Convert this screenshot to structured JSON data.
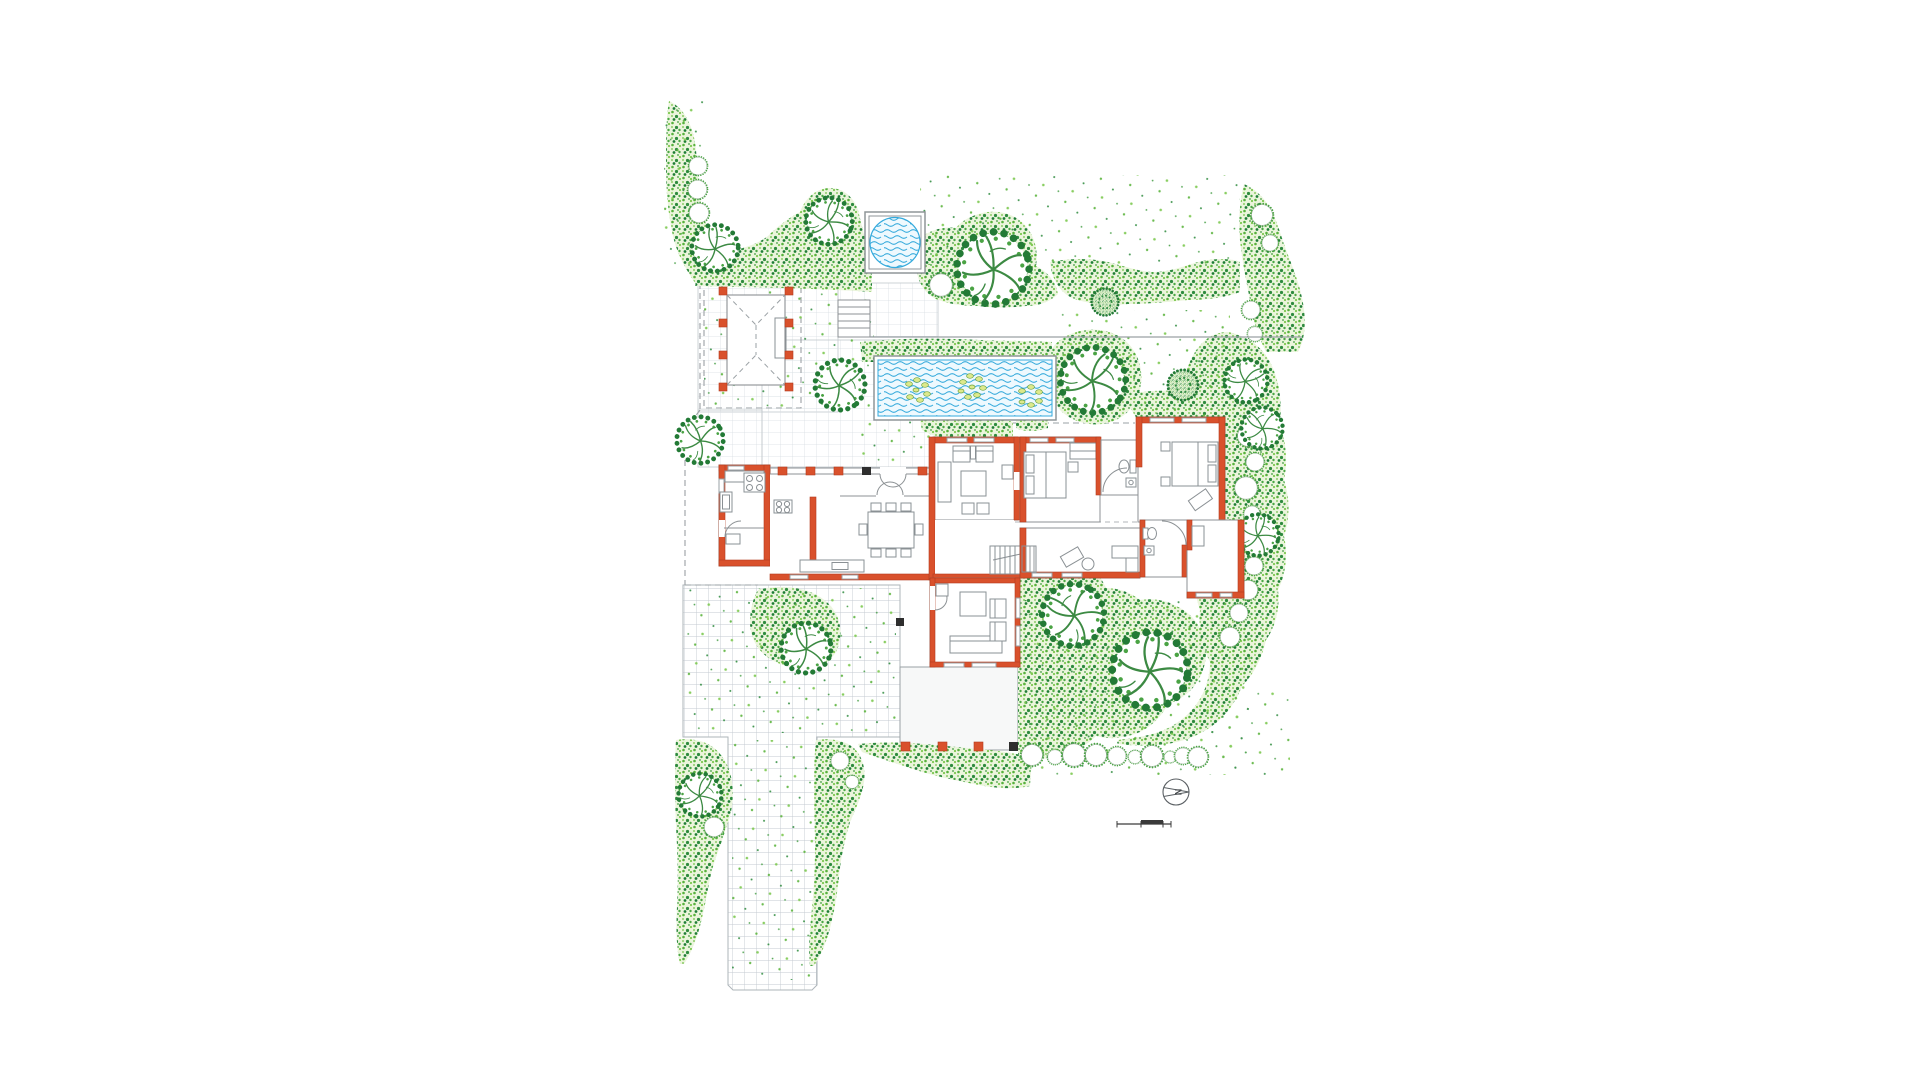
{
  "document": {
    "kind": "hand-rendered landscape site plan with ground-floor house plan",
    "visible_text": [
      "N"
    ]
  },
  "compass": {
    "label": "N"
  },
  "scale_bar": {
    "style": "stepped metric bar, unlabeled ticks"
  },
  "palette": {
    "background": "#ffffff",
    "foliage_wash": "#ebf5dc",
    "foliage_light": "#7cc84f",
    "foliage_mid": "#4aa844",
    "foliage_dark": "#1e7d36",
    "tree_outline": "#237a36",
    "branch_green": "#3c8a43",
    "water_line": "#35aadc",
    "water_fill": "#eef9fe",
    "lily_green": "#dde98c",
    "wall_red": "#d9512c",
    "line_grey": "#8c9194",
    "grid_grey": "#cdd4d8",
    "pier_black": "#2e2e2e",
    "frame_grey": "#8f9598"
  },
  "plan": {
    "elements": [
      "boundary-hedges",
      "specimen-trees",
      "shrub-balls",
      "clipped-shrub-rows",
      "square-plunge-pool",
      "rectangular-lily-pond",
      "pergola",
      "garden-steps",
      "paved-terrace",
      "gravel-courtyard",
      "driveway",
      "kitchen-wing",
      "kitchen",
      "scullery",
      "open-dining-hall",
      "kitchen-island",
      "entry-doors",
      "living-room",
      "stair-hall",
      "staircase",
      "bedroom-1",
      "bathroom-1",
      "bedroom-2",
      "study",
      "bathroom-2",
      "guest-room",
      "garden-room",
      "loggia-porch",
      "bedroom-terrace",
      "north-arrow",
      "scale-bar"
    ]
  }
}
